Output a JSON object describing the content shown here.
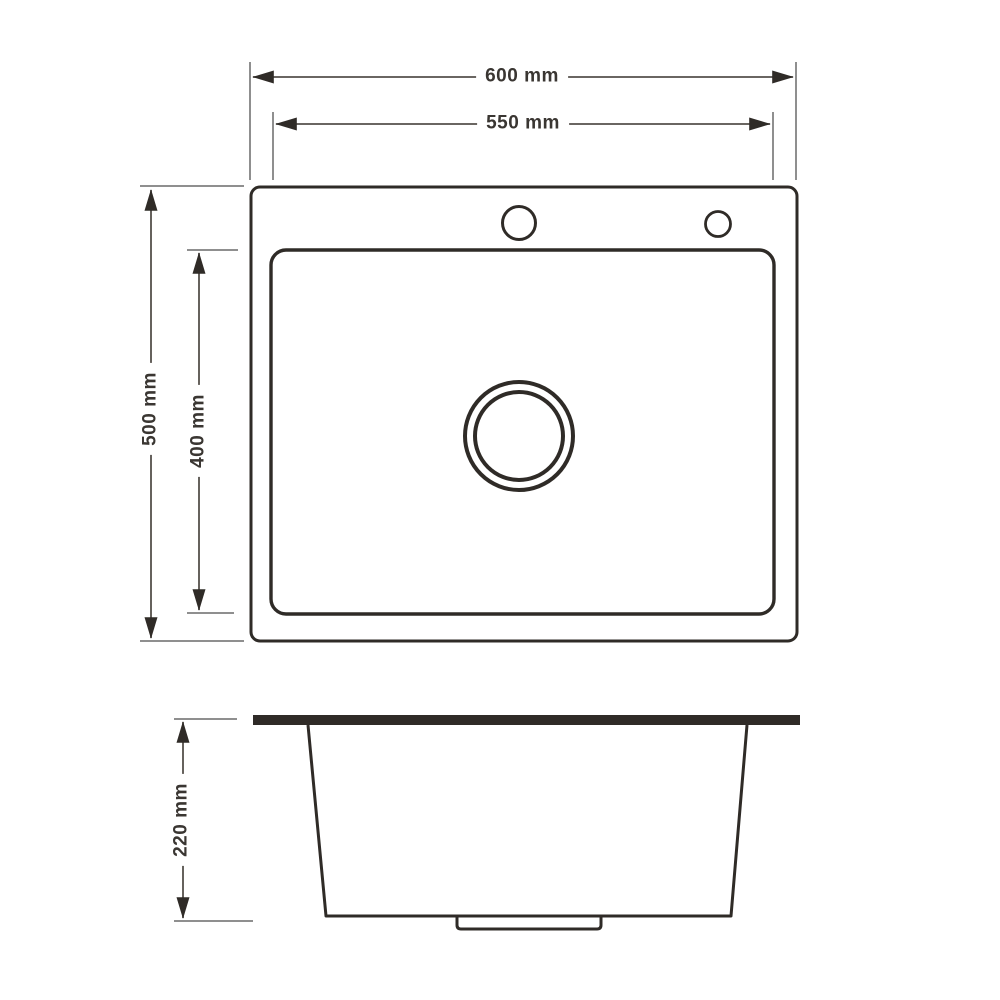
{
  "page": {
    "background_color": "#ffffff"
  },
  "diagram": {
    "type": "technical-drawing",
    "subject": "kitchen sink dimension drawing, top view and section view",
    "colors": {
      "outline": "#2f2b27",
      "dimension_line": "#55504b",
      "extension_line": "#8f8f8f",
      "arrowhead": "#2f2b27",
      "label_text": "#3a3632"
    },
    "top_view": {
      "name": "top view",
      "labels": {
        "outer_width": "600 mm",
        "bowl_width": "550 mm",
        "outer_depth": "500 mm",
        "bowl_depth": "400 mm"
      },
      "dimensions": [
        {
          "name": "outer width",
          "value": 600,
          "unit": "mm"
        },
        {
          "name": "bowl width",
          "value": 550,
          "unit": "mm"
        },
        {
          "name": "outer depth",
          "value": 500,
          "unit": "mm"
        },
        {
          "name": "bowl depth",
          "value": 400,
          "unit": "mm"
        }
      ],
      "features": [
        "faucet-hole-main",
        "faucet-hole-secondary",
        "drain-double-ring"
      ]
    },
    "section_view": {
      "name": "section view",
      "labels": {
        "bowl_height": "220 mm"
      },
      "dimensions": [
        {
          "name": "bowl height",
          "value": 220,
          "unit": "mm"
        }
      ],
      "features": [
        "countertop-rim",
        "tapered-bowl",
        "drain-lip"
      ]
    }
  }
}
